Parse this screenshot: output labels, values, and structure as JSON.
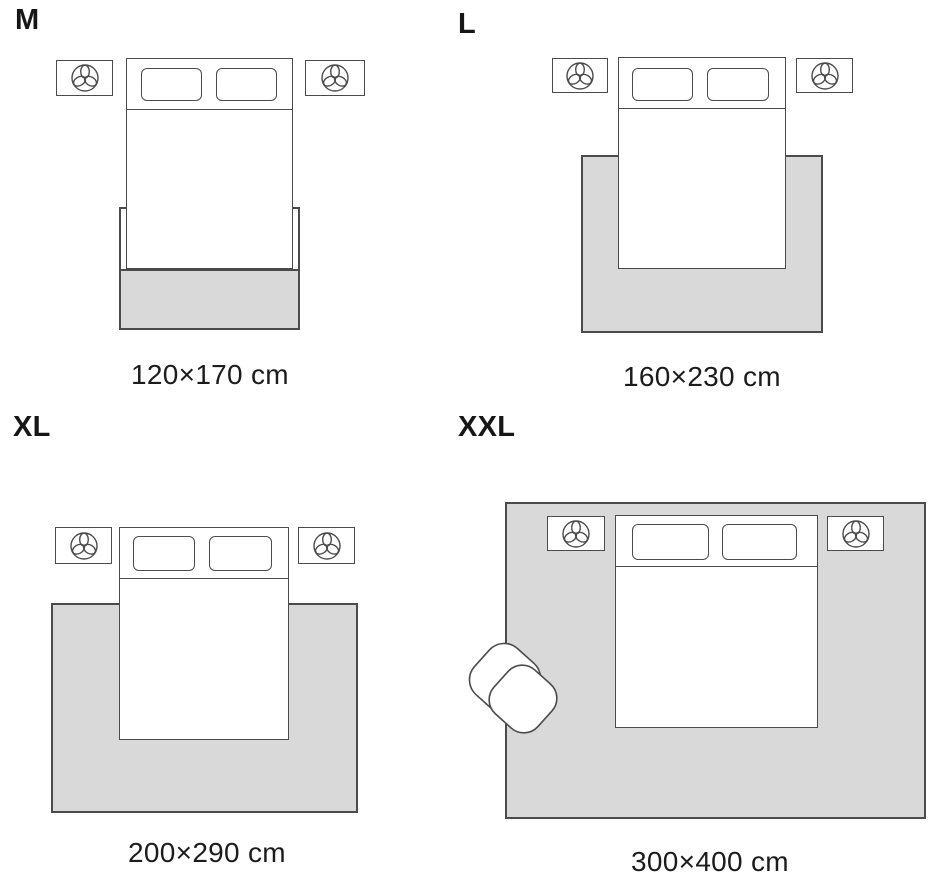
{
  "title_labels_note": "static rug size guide diagram",
  "colors": {
    "background": "#ffffff",
    "rug_fill": "#d9d9d9",
    "outline": "#4b4b4b",
    "text": "#1c1c1c"
  },
  "icons": {
    "nightstand_icon": "plant-top-view-icon",
    "seating_icon": "armchair-top-view-icon"
  },
  "panels": [
    {
      "size_label": "M",
      "dimensions": "120×170 cm"
    },
    {
      "size_label": "L",
      "dimensions": "160×230 cm"
    },
    {
      "size_label": "XL",
      "dimensions": "200×290 cm"
    },
    {
      "size_label": "XXL",
      "dimensions": "300×400 cm"
    }
  ]
}
